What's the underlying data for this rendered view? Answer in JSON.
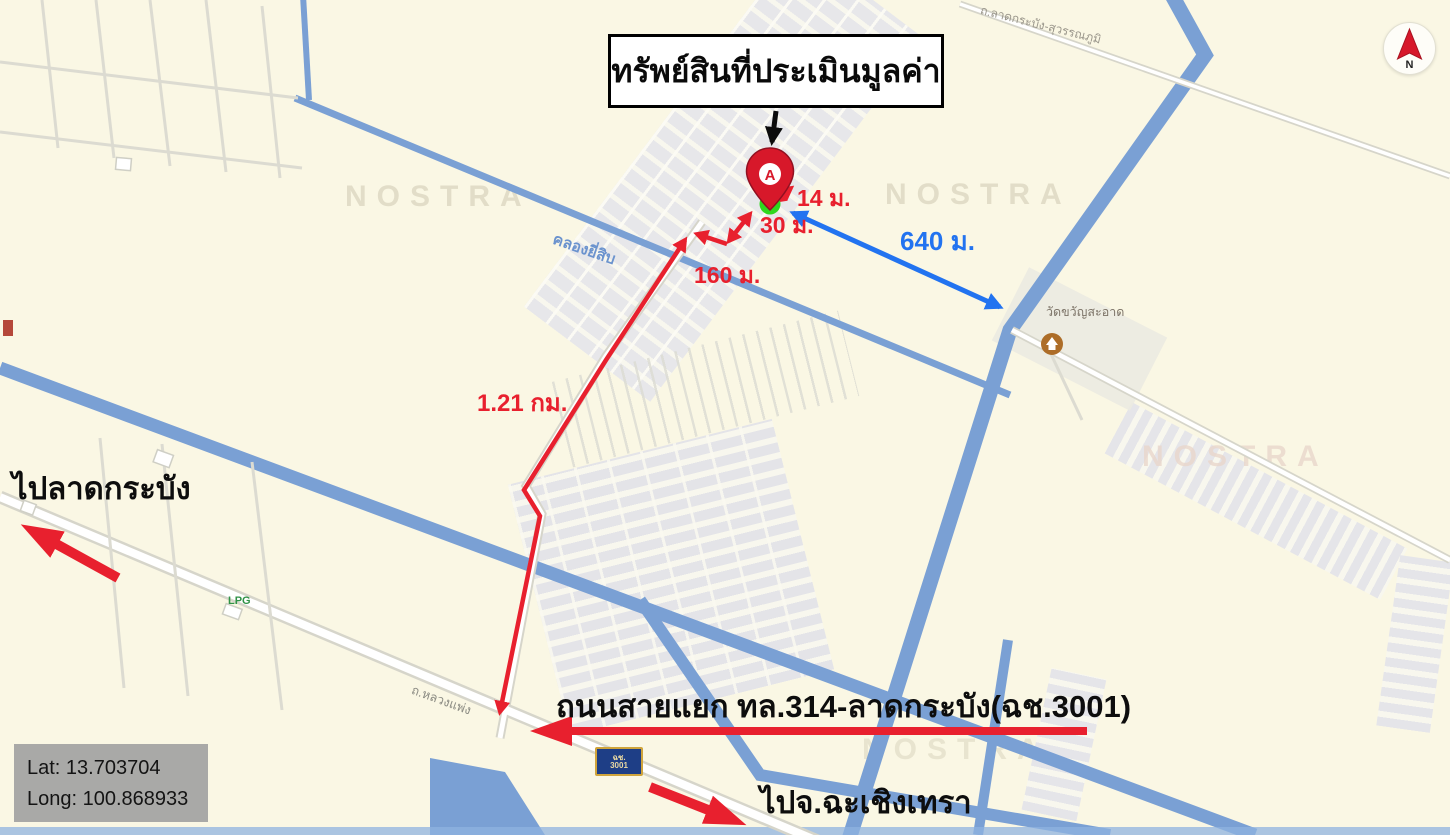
{
  "annotations": {
    "title": "ทรัพย์สินที่ประเมินมูลค่า",
    "marker_letter": "A",
    "dist_14m": "14 ม.",
    "dist_30m": "30 ม.",
    "dist_160m": "160 ม.",
    "dist_1_21km": "1.21 กม.",
    "dist_640m": "640 ม.",
    "road_junction_label": "ถนนสายแยก ทล.314-ลาดกระบัง(ฉช.3001)",
    "to_lat_krabang": "ไปลาดกระบัง",
    "to_chachoengsao": "ไปจ.ฉะเชิงเทรา"
  },
  "coordinates": {
    "lat": "Lat: 13.703704",
    "long": "Long: 100.868933"
  },
  "map_labels": {
    "canal": "คลองยี่สิบ",
    "road_luang_phaeng": "ถ.หลวงแพ่ง",
    "road_lat_krabang_suvarnabhumi": "ถ.ลาดกระบัง-สุวรรณภูมิ",
    "temple": "วัดขวัญสะอาด",
    "lpg": "LPG",
    "watermark": "NOSTRA",
    "route_sign_line1": "ฉช.",
    "route_sign_line2": "3001"
  },
  "compass": {
    "north": "N"
  },
  "colors": {
    "annotation_red": "#E8202E",
    "annotation_blue": "#2273F0",
    "marker_green": "#2FD71F",
    "canal_blue": "#7AA0D4",
    "background_cream": "#FAF7E4"
  }
}
